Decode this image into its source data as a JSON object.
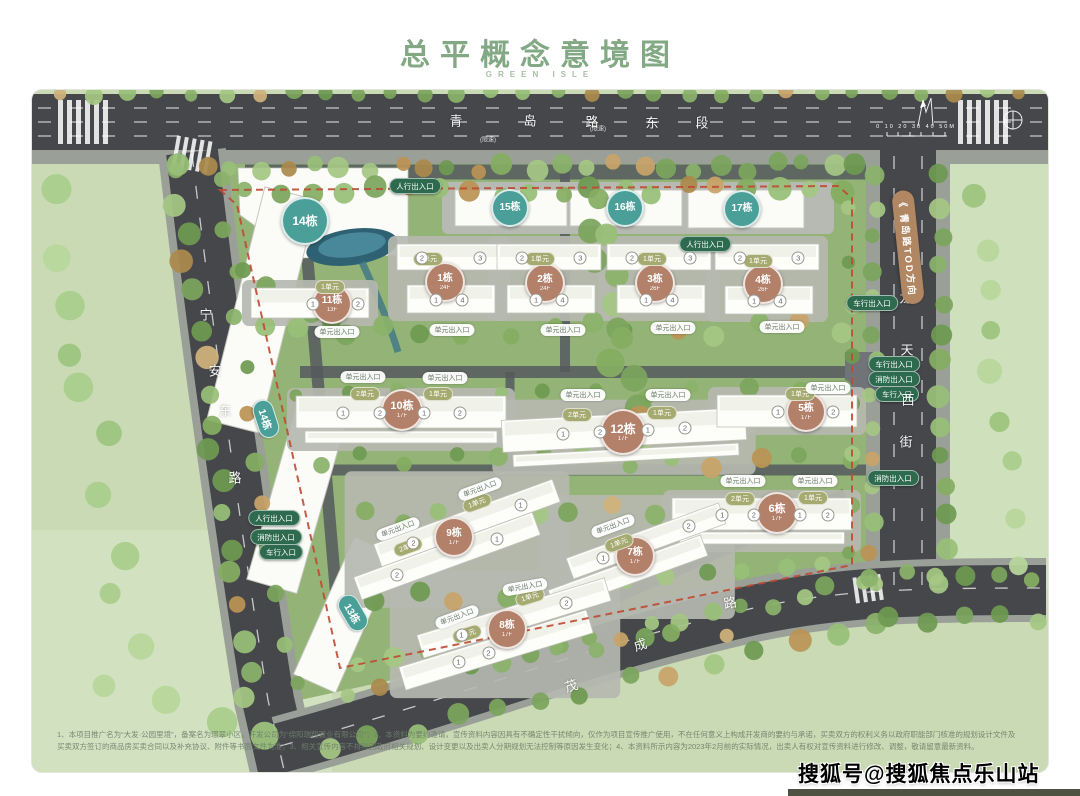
{
  "page": {
    "title": "总平概念意境图",
    "subtitle": "GREEN ISLE",
    "watermark": "搜狐号@搜狐焦点乐山站",
    "disclaimer": "1、本项目推广名为“大发·公园里境”，备案名为璟翠小区，开发公司为“绵阳瑞翔置业有限公司”；2、本资料为要约邀请，宣传资料内容因具有不确定性干扰倾向，仅作为项目宣传推广使用，不在任何意义上构成开发商的要约与承诺，买卖双方的权利义务以政府职能部门核准的规划设计文件及买卖双方签订的商品房买卖合同以及补充协议、附件等书面文件为准；3、相关宣传内容不排除因政府相关规划、设计变更以及出卖人分期规划无法控制等原因发生变化；4、本资料所示内容为2023年2月前的实际情况，出卖人有权对宣传资料进行修改、调整，敬请留意最新资料。"
  },
  "compass": {
    "scale_label": "0  10  20  30  40  50M"
  },
  "roads": {
    "top": {
      "name": "青岛路东段",
      "chars": [
        [
          "青",
          456,
          120
        ],
        [
          "岛",
          530,
          120
        ],
        [
          "路",
          592,
          121
        ],
        [
          "东",
          652,
          122
        ],
        [
          "段",
          702,
          122
        ]
      ]
    },
    "left": {
      "name": "宁安东路",
      "chars": [
        [
          "宁",
          206,
          314
        ],
        [
          "安",
          215,
          370
        ],
        [
          "东",
          225,
          410
        ],
        [
          "路",
          235,
          477
        ]
      ]
    },
    "right": {
      "name": "龙天西街",
      "chars": [
        [
          "龙",
          906,
          297
        ],
        [
          "天",
          907,
          349
        ],
        [
          "西",
          908,
          399
        ],
        [
          "街",
          906,
          441
        ]
      ]
    },
    "bottom": {
      "name": "茂成路",
      "chars": [
        [
          "茂",
          571,
          685,
          -18
        ],
        [
          "成",
          640,
          644,
          -18
        ],
        [
          "路",
          730,
          602,
          -10
        ]
      ]
    },
    "tod_label": "《 青岛路TOD方向",
    "marks": [
      [
        "(限速)",
        488,
        139
      ],
      [
        "(限速)",
        598,
        128
      ]
    ]
  },
  "labels": {
    "door": "单元出入口"
  },
  "badges": [
    {
      "label": "14栋",
      "type": "teal",
      "shape": "circle",
      "x": 305,
      "y": 221,
      "d": 44
    },
    {
      "label": "15栋",
      "type": "teal",
      "shape": "circle",
      "x": 510,
      "y": 208,
      "d": 34
    },
    {
      "label": "16栋",
      "type": "teal",
      "shape": "circle",
      "x": 625,
      "y": 208,
      "d": 34
    },
    {
      "label": "17栋",
      "type": "teal",
      "shape": "circle",
      "x": 742,
      "y": 209,
      "d": 34
    },
    {
      "label": "14栋",
      "type": "teal",
      "shape": "pill",
      "x": 266,
      "y": 419,
      "rot": 72
    },
    {
      "label": "13栋",
      "type": "teal",
      "shape": "pill",
      "x": 353,
      "y": 613,
      "rot": 60
    },
    {
      "label": "11栋",
      "floors": "13F",
      "type": "brown",
      "shape": "circle",
      "x": 332,
      "y": 304,
      "d": 36
    },
    {
      "label": "1栋",
      "floors": "24F",
      "type": "brown",
      "shape": "circle",
      "x": 445,
      "y": 282,
      "d": 36
    },
    {
      "label": "2栋",
      "floors": "24F",
      "type": "brown",
      "shape": "circle",
      "x": 545,
      "y": 283,
      "d": 36
    },
    {
      "label": "3栋",
      "floors": "26F",
      "type": "brown",
      "shape": "circle",
      "x": 655,
      "y": 283,
      "d": 36
    },
    {
      "label": "4栋",
      "floors": "26F",
      "type": "brown",
      "shape": "circle",
      "x": 763,
      "y": 284,
      "d": 36
    },
    {
      "label": "10栋",
      "floors": "17F",
      "type": "brown",
      "shape": "circle",
      "x": 402,
      "y": 410,
      "d": 38
    },
    {
      "label": "12栋",
      "floors": "17F",
      "type": "brown",
      "shape": "circle",
      "x": 623,
      "y": 432,
      "d": 42
    },
    {
      "label": "5栋",
      "floors": "17F",
      "type": "brown",
      "shape": "circle",
      "x": 806,
      "y": 412,
      "d": 36
    },
    {
      "label": "9栋",
      "floors": "17F",
      "type": "brown",
      "shape": "circle",
      "x": 454,
      "y": 537,
      "d": 36
    },
    {
      "label": "7栋",
      "floors": "17F",
      "type": "brown",
      "shape": "circle",
      "x": 635,
      "y": 556,
      "d": 36
    },
    {
      "label": "6栋",
      "floors": "17F",
      "type": "brown",
      "shape": "circle",
      "x": 777,
      "y": 513,
      "d": 38
    },
    {
      "label": "8栋",
      "floors": "17F",
      "type": "brown",
      "shape": "circle",
      "x": 507,
      "y": 629,
      "d": 36
    }
  ],
  "unit_pills": [
    {
      "text": "1单元",
      "x": 330,
      "y": 287
    },
    {
      "text": "1单元",
      "x": 428,
      "y": 259
    },
    {
      "text": "1单元",
      "x": 540,
      "y": 259
    },
    {
      "text": "1单元",
      "x": 652,
      "y": 259
    },
    {
      "text": "1单元",
      "x": 758,
      "y": 261
    },
    {
      "text": "2单元",
      "x": 365,
      "y": 394
    },
    {
      "text": "1单元",
      "x": 438,
      "y": 394
    },
    {
      "text": "2单元",
      "x": 577,
      "y": 415
    },
    {
      "text": "1单元",
      "x": 662,
      "y": 413
    },
    {
      "text": "1单元",
      "x": 800,
      "y": 394
    },
    {
      "text": "2单元",
      "x": 740,
      "y": 499
    },
    {
      "text": "1单元",
      "x": 813,
      "y": 498
    },
    {
      "text": "1单元",
      "x": 477,
      "y": 503,
      "rot": -20
    },
    {
      "text": "2单元",
      "x": 408,
      "y": 547,
      "rot": -20
    },
    {
      "text": "1单元",
      "x": 619,
      "y": 543,
      "rot": -20
    },
    {
      "text": "1单元",
      "x": 530,
      "y": 597,
      "rot": -17
    },
    {
      "text": "2单元",
      "x": 467,
      "y": 634,
      "rot": -17
    }
  ],
  "door_pills": [
    {
      "x": 337,
      "y": 332
    },
    {
      "x": 452,
      "y": 330
    },
    {
      "x": 563,
      "y": 330
    },
    {
      "x": 673,
      "y": 328
    },
    {
      "x": 782,
      "y": 327
    },
    {
      "x": 363,
      "y": 377
    },
    {
      "x": 445,
      "y": 378
    },
    {
      "x": 583,
      "y": 395
    },
    {
      "x": 668,
      "y": 395
    },
    {
      "x": 828,
      "y": 388
    },
    {
      "x": 743,
      "y": 481
    },
    {
      "x": 815,
      "y": 481
    },
    {
      "x": 480,
      "y": 489,
      "rot": -20
    },
    {
      "x": 398,
      "y": 529,
      "rot": -20
    },
    {
      "x": 613,
      "y": 526,
      "rot": -20
    },
    {
      "x": 525,
      "y": 587,
      "rot": -10
    },
    {
      "x": 457,
      "y": 617,
      "rot": -20
    }
  ],
  "gates": [
    {
      "text": "人行出入口",
      "x": 415,
      "y": 186
    },
    {
      "text": "人行出入口",
      "x": 705,
      "y": 244
    },
    {
      "text": "车行出入口",
      "x": 872,
      "y": 303
    },
    {
      "text": "车行出入口",
      "x": 894,
      "y": 364
    },
    {
      "text": "消防出入口",
      "x": 894,
      "y": 379
    },
    {
      "text": "车行入口",
      "x": 897,
      "y": 394
    },
    {
      "text": "消防出入口",
      "x": 893,
      "y": 478
    },
    {
      "text": "人行出入口",
      "x": 274,
      "y": 518
    },
    {
      "text": "消防出入口",
      "x": 276,
      "y": 537
    },
    {
      "text": "车行入口",
      "x": 281,
      "y": 552
    }
  ],
  "slabs": [
    {
      "b": "11",
      "cx": 310,
      "cy": 303,
      "w": 118,
      "h": 30,
      "rot": 0,
      "units": [
        {
          "n": "1",
          "fx": 0.025
        },
        {
          "n": "2",
          "fx": 0.407
        }
      ]
    },
    {
      "b": "1",
      "cx": 449,
      "cy": 257,
      "w": 104,
      "h": 26,
      "rot": 0,
      "units": [
        {
          "n": "2",
          "fx": -0.26
        },
        {
          "n": "3",
          "fx": 0.3
        }
      ]
    },
    {
      "b": "1",
      "cx": 451,
      "cy": 299,
      "w": 88,
      "h": 28,
      "rot": 0,
      "units": [
        {
          "n": "1",
          "fx": -0.17
        },
        {
          "n": "4",
          "fx": 0.13
        }
      ]
    },
    {
      "b": "2",
      "cx": 549,
      "cy": 257,
      "w": 104,
      "h": 26,
      "rot": 0,
      "units": [
        {
          "n": "2",
          "fx": -0.26
        },
        {
          "n": "3",
          "fx": 0.3
        }
      ]
    },
    {
      "b": "2",
      "cx": 551,
      "cy": 299,
      "w": 88,
      "h": 28,
      "rot": 0,
      "units": [
        {
          "n": "1",
          "fx": -0.17
        },
        {
          "n": "4",
          "fx": 0.13
        }
      ]
    },
    {
      "b": "3",
      "cx": 659,
      "cy": 257,
      "w": 104,
      "h": 26,
      "rot": 0,
      "units": [
        {
          "n": "2",
          "fx": -0.26
        },
        {
          "n": "3",
          "fx": 0.3
        }
      ]
    },
    {
      "b": "3",
      "cx": 661,
      "cy": 299,
      "w": 88,
      "h": 28,
      "rot": 0,
      "units": [
        {
          "n": "1",
          "fx": -0.17
        },
        {
          "n": "4",
          "fx": 0.13
        }
      ]
    },
    {
      "b": "4",
      "cx": 767,
      "cy": 257,
      "w": 104,
      "h": 26,
      "rot": 0,
      "units": [
        {
          "n": "2",
          "fx": -0.26
        },
        {
          "n": "3",
          "fx": 0.3
        }
      ]
    },
    {
      "b": "4",
      "cx": 769,
      "cy": 300,
      "w": 88,
      "h": 28,
      "rot": 0,
      "units": [
        {
          "n": "1",
          "fx": -0.17
        },
        {
          "n": "4",
          "fx": 0.13
        }
      ]
    },
    {
      "b": "10",
      "cx": 401,
      "cy": 412,
      "w": 210,
      "h": 32,
      "rot": 0,
      "units": [
        {
          "n": "1",
          "fx": -0.276
        },
        {
          "n": "2",
          "fx": -0.1
        },
        {
          "n": "1",
          "fx": 0.11
        },
        {
          "n": "2",
          "fx": 0.28
        }
      ]
    },
    {
      "b": "10",
      "cx": 401,
      "cy": 437,
      "w": 192,
      "h": 12,
      "rot": 0,
      "units": []
    },
    {
      "b": "12",
      "cx": 624,
      "cy": 430,
      "w": 244,
      "h": 32,
      "rot": -3,
      "units": [
        {
          "n": "1",
          "fx": -0.25
        },
        {
          "n": "2",
          "fx": -0.098
        },
        {
          "n": "1",
          "fx": 0.098
        },
        {
          "n": "2",
          "fx": 0.25
        }
      ]
    },
    {
      "b": "12",
      "cx": 626,
      "cy": 455,
      "w": 226,
      "h": 12,
      "rot": -3,
      "units": []
    },
    {
      "b": "5",
      "cx": 787,
      "cy": 411,
      "w": 140,
      "h": 32,
      "rot": 0,
      "units": [
        {
          "n": "1",
          "fx": -0.064
        },
        {
          "n": "2",
          "fx": 0.33
        }
      ]
    },
    {
      "b": "6",
      "cx": 762,
      "cy": 514,
      "w": 180,
      "h": 32,
      "rot": 0,
      "units": [
        {
          "n": "1",
          "fx": -0.22
        },
        {
          "n": "2",
          "fx": -0.045
        },
        {
          "n": "1",
          "fx": 0.21
        },
        {
          "n": "2",
          "fx": 0.365
        }
      ]
    },
    {
      "b": "6",
      "cx": 762,
      "cy": 538,
      "w": 165,
      "h": 12,
      "rot": 0,
      "units": []
    },
    {
      "b": "9",
      "cx": 467,
      "cy": 523,
      "w": 190,
      "h": 24,
      "rot": -20,
      "units": [
        {
          "n": "2",
          "fx": -0.3
        },
        {
          "n": "1",
          "fx": 0.3
        }
      ]
    },
    {
      "b": "9",
      "cx": 447,
      "cy": 556,
      "w": 190,
      "h": 24,
      "rot": -20,
      "units": [
        {
          "n": "2",
          "fx": -0.28
        },
        {
          "n": "1",
          "fx": 0.28
        }
      ]
    },
    {
      "b": "7",
      "cx": 646,
      "cy": 541,
      "w": 162,
      "h": 22,
      "rot": -20,
      "units": [
        {
          "n": "1",
          "fx": -0.28
        },
        {
          "n": "2",
          "fx": 0.28
        }
      ]
    },
    {
      "b": "7",
      "cx": 628,
      "cy": 573,
      "w": 162,
      "h": 22,
      "rot": -20,
      "units": []
    },
    {
      "b": "8",
      "cx": 514,
      "cy": 618,
      "w": 196,
      "h": 24,
      "rot": -17,
      "units": [
        {
          "n": "1",
          "fx": -0.28
        },
        {
          "n": "2",
          "fx": 0.28
        }
      ]
    },
    {
      "b": "8",
      "cx": 496,
      "cy": 650,
      "w": 196,
      "h": 24,
      "rot": -17,
      "units": [
        {
          "n": "1",
          "fx": -0.2
        },
        {
          "n": "2",
          "fx": -0.04
        }
      ]
    }
  ]
}
